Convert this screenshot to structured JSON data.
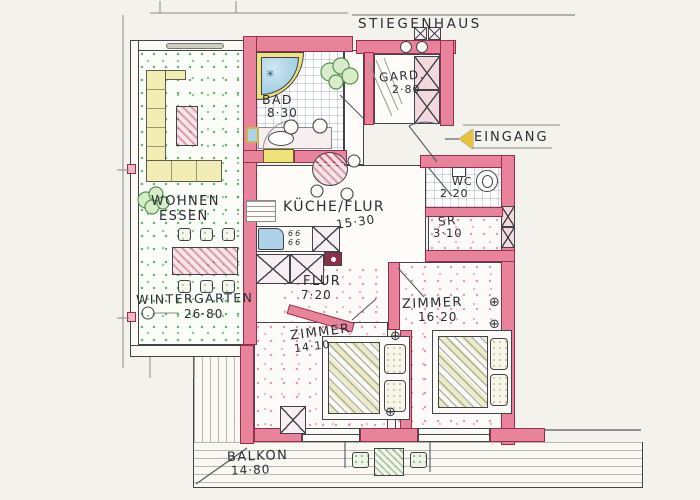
{
  "title": {
    "label": "Stiegenhaus"
  },
  "entrance": {
    "label": "Eingang"
  },
  "rooms": {
    "bad": {
      "name": "Bad",
      "area": "8·30"
    },
    "gard": {
      "name": "Gard.",
      "area": "2·80"
    },
    "wc": {
      "name": "WC",
      "area": "2·20"
    },
    "sr": {
      "name": "SR",
      "area": "3·10"
    },
    "kueche_flur": {
      "name": "Küche/Flur",
      "area": "15·30"
    },
    "wohnen_essen": {
      "line1": "Wohnen",
      "line2": "Essen"
    },
    "wintergarten": {
      "name": "Wintergarten",
      "area": "26·80"
    },
    "flur": {
      "name": "Flur",
      "area": "7·20"
    },
    "zimmer_klein": {
      "name": "Zimmer",
      "area": "14·10"
    },
    "zimmer_gross": {
      "name": "Zimmer",
      "area": "16·20"
    },
    "balkon": {
      "name": "Balkon",
      "area": "14·80"
    }
  },
  "kitchen": {
    "cooktop_marks": [
      "66",
      "66"
    ]
  },
  "symbols": {
    "radiator": "⊕",
    "shower_jet": "✳"
  },
  "colors": {
    "wall_pink": "#e8839b",
    "wall_outline": "#93304c",
    "floor_speckle_green": "#3c964b",
    "floor_speckle_red": "#cd5f78",
    "furniture_yellow": "#f2edb5",
    "water_blue": "#aed3e8",
    "door_yellow": "#f0e27a"
  }
}
